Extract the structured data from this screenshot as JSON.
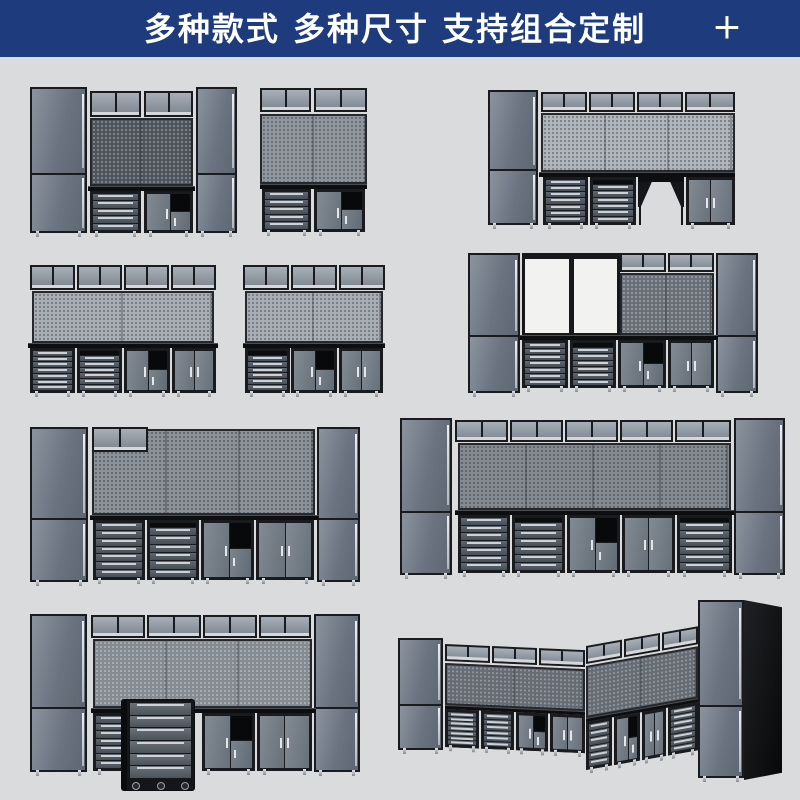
{
  "banner": {
    "title": "多种款式 多种尺寸 支持组合定制",
    "plus_icon": "+",
    "bg_color": "#1e3c7d",
    "text_color": "#ffffff"
  },
  "page": {
    "bg_color": "#dadbdc",
    "width": 800,
    "height": 800
  },
  "palette": {
    "frame": "#1a1b1e",
    "door_gray": "#6b7380",
    "silver": "#cdd1d5",
    "bench_black": "#0d0e10",
    "open_bay_white": "#f2f2f1"
  },
  "scene": {
    "units": [
      {
        "id": "combo-1",
        "x": 30,
        "y": 87,
        "w": 207,
        "h": 153,
        "parts": [
          {
            "t": "tall",
            "x": 0,
            "y": 0,
            "w": 57,
            "h": 146,
            "feet": 1
          },
          {
            "t": "wall",
            "x": 60,
            "y": 4,
            "w": 51,
            "h": 26
          },
          {
            "t": "wall",
            "x": 114,
            "y": 4,
            "w": 49,
            "h": 26
          },
          {
            "t": "peg",
            "x": 60,
            "y": 31,
            "w": 103,
            "h": 68,
            "c": "#4e545c",
            "d": "light"
          },
          {
            "t": "bench",
            "x": 58,
            "y": 99,
            "w": 107,
            "h": 5
          },
          {
            "t": "drawers",
            "x": 60,
            "y": 104,
            "w": 51,
            "h": 42,
            "n": 5,
            "feet": 1
          },
          {
            "t": "cubby",
            "x": 114,
            "y": 104,
            "w": 49,
            "h": 42,
            "feet": 1
          },
          {
            "t": "tall",
            "x": 166,
            "y": 0,
            "w": 41,
            "h": 146,
            "feet": 1
          }
        ]
      },
      {
        "id": "combo-2",
        "x": 260,
        "y": 88,
        "w": 107,
        "h": 152,
        "parts": [
          {
            "t": "wall",
            "x": 0,
            "y": 0,
            "w": 51,
            "h": 24
          },
          {
            "t": "wall",
            "x": 54,
            "y": 0,
            "w": 53,
            "h": 24
          },
          {
            "t": "peg",
            "x": 0,
            "y": 26,
            "w": 107,
            "h": 70,
            "c": "#90969e",
            "d": "dark"
          },
          {
            "t": "bench",
            "x": 0,
            "y": 96,
            "w": 107,
            "h": 5
          },
          {
            "t": "drawers",
            "x": 2,
            "y": 101,
            "w": 49,
            "h": 43,
            "n": 5,
            "feet": 1
          },
          {
            "t": "cubby",
            "x": 54,
            "y": 101,
            "w": 51,
            "h": 43,
            "feet": 1
          }
        ]
      },
      {
        "id": "combo-3",
        "x": 488,
        "y": 90,
        "w": 247,
        "h": 143,
        "parts": [
          {
            "t": "tall",
            "x": 0,
            "y": 0,
            "w": 50,
            "h": 135,
            "feet": 1
          },
          {
            "t": "wall",
            "x": 53,
            "y": 2,
            "w": 46,
            "h": 20
          },
          {
            "t": "wall",
            "x": 101,
            "y": 2,
            "w": 46,
            "h": 20
          },
          {
            "t": "wall",
            "x": 149,
            "y": 2,
            "w": 46,
            "h": 20
          },
          {
            "t": "wall",
            "x": 197,
            "y": 2,
            "w": 50,
            "h": 20
          },
          {
            "t": "peg",
            "x": 53,
            "y": 23,
            "w": 194,
            "h": 59,
            "c": "#b0b5bb",
            "d": "dark"
          },
          {
            "t": "bench",
            "x": 51,
            "y": 82,
            "w": 196,
            "h": 5
          },
          {
            "t": "drawers",
            "x": 55,
            "y": 87,
            "w": 45,
            "h": 48,
            "n": 7,
            "feet": 1
          },
          {
            "t": "drawers",
            "x": 102,
            "y": 87,
            "w": 46,
            "h": 48,
            "n": 6,
            "rail": 1,
            "feet": 1
          },
          {
            "t": "gap",
            "x": 150,
            "y": 87,
            "w": 46,
            "h": 48
          },
          {
            "t": "doors2",
            "x": 198,
            "y": 87,
            "w": 49,
            "h": 48,
            "feet": 1
          }
        ]
      },
      {
        "id": "combo-4",
        "x": 28,
        "y": 265,
        "w": 190,
        "h": 134,
        "parts": [
          {
            "t": "wall",
            "x": 2,
            "y": 0,
            "w": 45,
            "h": 25
          },
          {
            "t": "wall",
            "x": 49,
            "y": 0,
            "w": 45,
            "h": 25
          },
          {
            "t": "wall",
            "x": 96,
            "y": 0,
            "w": 45,
            "h": 25
          },
          {
            "t": "wall",
            "x": 143,
            "y": 0,
            "w": 45,
            "h": 25
          },
          {
            "t": "peg",
            "x": 4,
            "y": 26,
            "w": 182,
            "h": 52,
            "c": "#a9aeb5",
            "d": "dark"
          },
          {
            "t": "bench",
            "x": 0,
            "y": 78,
            "w": 190,
            "h": 5
          },
          {
            "t": "drawers",
            "x": 2,
            "y": 83,
            "w": 45,
            "h": 45,
            "n": 7,
            "feet": 1
          },
          {
            "t": "drawers",
            "x": 49,
            "y": 83,
            "w": 45,
            "h": 45,
            "n": 6,
            "rail": 1,
            "feet": 1
          },
          {
            "t": "cubby",
            "x": 96,
            "y": 83,
            "w": 46,
            "h": 45,
            "feet": 1
          },
          {
            "t": "doors2",
            "x": 144,
            "y": 83,
            "w": 44,
            "h": 45,
            "feet": 1
          }
        ]
      },
      {
        "id": "combo-5",
        "x": 243,
        "y": 265,
        "w": 142,
        "h": 134,
        "parts": [
          {
            "t": "wall",
            "x": 0,
            "y": 0,
            "w": 46,
            "h": 25
          },
          {
            "t": "wall",
            "x": 48,
            "y": 0,
            "w": 46,
            "h": 25
          },
          {
            "t": "wall",
            "x": 96,
            "y": 0,
            "w": 46,
            "h": 25
          },
          {
            "t": "peg",
            "x": 2,
            "y": 26,
            "w": 138,
            "h": 52,
            "c": "#a9aeb5",
            "d": "dark"
          },
          {
            "t": "bench",
            "x": 0,
            "y": 78,
            "w": 142,
            "h": 5
          },
          {
            "t": "drawers",
            "x": 2,
            "y": 83,
            "w": 45,
            "h": 45,
            "n": 6,
            "rail": 1,
            "feet": 1
          },
          {
            "t": "cubby",
            "x": 48,
            "y": 83,
            "w": 46,
            "h": 45,
            "feet": 1
          },
          {
            "t": "doors2",
            "x": 96,
            "y": 83,
            "w": 44,
            "h": 45,
            "feet": 1
          }
        ]
      },
      {
        "id": "combo-6",
        "x": 468,
        "y": 250,
        "w": 290,
        "h": 150,
        "parts": [
          {
            "t": "tall",
            "x": 0,
            "y": 3,
            "w": 52,
            "h": 140,
            "feet": 1
          },
          {
            "t": "open",
            "x": 54,
            "y": 3,
            "w": 98,
            "h": 83
          },
          {
            "t": "wall",
            "x": 152,
            "y": 3,
            "w": 46,
            "h": 19
          },
          {
            "t": "wall",
            "x": 200,
            "y": 3,
            "w": 46,
            "h": 19
          },
          {
            "t": "peg",
            "x": 152,
            "y": 23,
            "w": 94,
            "h": 62,
            "c": "#6a7078",
            "d": "light"
          },
          {
            "t": "tall",
            "x": 248,
            "y": 3,
            "w": 42,
            "h": 140,
            "feet": 1
          },
          {
            "t": "bench",
            "x": 52,
            "y": 85,
            "w": 198,
            "h": 5
          },
          {
            "t": "drawers",
            "x": 54,
            "y": 90,
            "w": 46,
            "h": 48,
            "n": 7,
            "feet": 1
          },
          {
            "t": "drawers",
            "x": 102,
            "y": 90,
            "w": 46,
            "h": 48,
            "n": 6,
            "rail": 1,
            "feet": 1
          },
          {
            "t": "cubby",
            "x": 150,
            "y": 90,
            "w": 48,
            "h": 48,
            "feet": 1
          },
          {
            "t": "doors2",
            "x": 200,
            "y": 90,
            "w": 46,
            "h": 48,
            "feet": 1
          }
        ]
      },
      {
        "id": "combo-7",
        "x": 30,
        "y": 425,
        "w": 330,
        "h": 163,
        "parts": [
          {
            "t": "tall",
            "x": 0,
            "y": 2,
            "w": 58,
            "h": 155,
            "feet": 1
          },
          {
            "t": "peg",
            "x": 62,
            "y": 4,
            "w": 223,
            "h": 86,
            "c": "#8b9199",
            "d": "dark"
          },
          {
            "t": "wall",
            "x": 62,
            "y": 2,
            "w": 56,
            "h": 25
          },
          {
            "t": "tall",
            "x": 287,
            "y": 2,
            "w": 43,
            "h": 155,
            "feet": 1
          },
          {
            "t": "bench",
            "x": 60,
            "y": 90,
            "w": 229,
            "h": 5
          },
          {
            "t": "drawers",
            "x": 63,
            "y": 95,
            "w": 52,
            "h": 60,
            "n": 7,
            "feet": 1
          },
          {
            "t": "drawers",
            "x": 117,
            "y": 95,
            "w": 52,
            "h": 60,
            "n": 6,
            "rail": 1,
            "feet": 1
          },
          {
            "t": "cubby",
            "x": 171,
            "y": 95,
            "w": 53,
            "h": 60,
            "feet": 1
          },
          {
            "t": "doors2",
            "x": 226,
            "y": 95,
            "w": 58,
            "h": 60,
            "feet": 1
          }
        ]
      },
      {
        "id": "combo-8",
        "x": 400,
        "y": 418,
        "w": 385,
        "h": 164,
        "parts": [
          {
            "t": "tall",
            "x": 0,
            "y": 0,
            "w": 52,
            "h": 157,
            "feet": 1
          },
          {
            "t": "wall",
            "x": 55,
            "y": 2,
            "w": 53,
            "h": 22
          },
          {
            "t": "wall",
            "x": 110,
            "y": 2,
            "w": 53,
            "h": 22
          },
          {
            "t": "wall",
            "x": 165,
            "y": 2,
            "w": 53,
            "h": 22
          },
          {
            "t": "wall",
            "x": 220,
            "y": 2,
            "w": 53,
            "h": 22
          },
          {
            "t": "wall",
            "x": 275,
            "y": 2,
            "w": 56,
            "h": 22
          },
          {
            "t": "peg",
            "x": 58,
            "y": 25,
            "w": 273,
            "h": 67,
            "c": "#848a92",
            "d": "dark"
          },
          {
            "t": "tall",
            "x": 334,
            "y": 0,
            "w": 51,
            "h": 157,
            "feet": 1
          },
          {
            "t": "bench",
            "x": 55,
            "y": 92,
            "w": 279,
            "h": 5
          },
          {
            "t": "drawers",
            "x": 58,
            "y": 97,
            "w": 52,
            "h": 58,
            "n": 7,
            "feet": 1
          },
          {
            "t": "drawers",
            "x": 112,
            "y": 97,
            "w": 53,
            "h": 58,
            "n": 6,
            "rail": 1,
            "feet": 1
          },
          {
            "t": "cubby",
            "x": 167,
            "y": 97,
            "w": 53,
            "h": 58,
            "feet": 1
          },
          {
            "t": "doors2",
            "x": 222,
            "y": 97,
            "w": 53,
            "h": 58,
            "feet": 1
          },
          {
            "t": "drawers",
            "x": 277,
            "y": 97,
            "w": 55,
            "h": 58,
            "n": 6,
            "rail": 1,
            "feet": 1
          }
        ]
      },
      {
        "id": "combo-9",
        "x": 30,
        "y": 612,
        "w": 330,
        "h": 178,
        "parts": [
          {
            "t": "tall",
            "x": 0,
            "y": 2,
            "w": 57,
            "h": 158,
            "feet": 1
          },
          {
            "t": "wall",
            "x": 61,
            "y": 3,
            "w": 54,
            "h": 23
          },
          {
            "t": "wall",
            "x": 117,
            "y": 3,
            "w": 54,
            "h": 23
          },
          {
            "t": "wall",
            "x": 173,
            "y": 3,
            "w": 54,
            "h": 23
          },
          {
            "t": "wall",
            "x": 229,
            "y": 3,
            "w": 52,
            "h": 23
          },
          {
            "t": "peg",
            "x": 63,
            "y": 27,
            "w": 219,
            "h": 69,
            "c": "#858b93",
            "d": "light"
          },
          {
            "t": "tall",
            "x": 284,
            "y": 2,
            "w": 46,
            "h": 158,
            "feet": 1
          },
          {
            "t": "bench",
            "x": 61,
            "y": 96,
            "w": 225,
            "h": 5
          },
          {
            "t": "drawers",
            "x": 63,
            "y": 101,
            "w": 50,
            "h": 58,
            "n": 7,
            "feet": 1
          },
          {
            "t": "cubby",
            "x": 172,
            "y": 101,
            "w": 53,
            "h": 58,
            "feet": 1
          },
          {
            "t": "doors2",
            "x": 227,
            "y": 101,
            "w": 55,
            "h": 58,
            "feet": 1
          },
          {
            "t": "cart",
            "x": 92,
            "y": 88,
            "w": 72,
            "h": 90
          }
        ]
      },
      {
        "id": "combo-10-corner",
        "x": 395,
        "y": 598,
        "w": 395,
        "h": 196,
        "parts": [
          {
            "t": "tall",
            "x": 3,
            "y": 40,
            "w": 45,
            "h": 112,
            "feet": 1
          },
          {
            "t": "wing",
            "x": 50,
            "y": 46,
            "w": 140,
            "h": 104,
            "skew": 2.5,
            "parts": [
              {
                "t": "wall",
                "x": 0,
                "y": 0,
                "w": 45,
                "h": 17
              },
              {
                "t": "wall",
                "x": 47,
                "y": 0,
                "w": 45,
                "h": 17
              },
              {
                "t": "wall",
                "x": 94,
                "y": 0,
                "w": 46,
                "h": 17
              },
              {
                "t": "peg",
                "x": 0,
                "y": 19,
                "w": 140,
                "h": 42,
                "c": "#666c74",
                "d": "light"
              },
              {
                "t": "bench",
                "x": 0,
                "y": 61,
                "w": 140,
                "h": 4
              },
              {
                "t": "drawers",
                "x": 0,
                "y": 65,
                "w": 34,
                "h": 38,
                "n": 7,
                "feet": 1
              },
              {
                "t": "drawers",
                "x": 36,
                "y": 65,
                "w": 33,
                "h": 38,
                "n": 6,
                "feet": 1
              },
              {
                "t": "cubby",
                "x": 71,
                "y": 65,
                "w": 32,
                "h": 38,
                "feet": 1
              },
              {
                "t": "doors2",
                "x": 105,
                "y": 65,
                "w": 35,
                "h": 38,
                "feet": 1
              }
            ]
          },
          {
            "t": "wing",
            "x": 191,
            "y": 48,
            "w": 112,
            "h": 124,
            "skew": -10,
            "parts": [
              {
                "t": "wall",
                "x": 0,
                "y": 0,
                "w": 36,
                "h": 18
              },
              {
                "t": "wall",
                "x": 38,
                "y": 0,
                "w": 36,
                "h": 18
              },
              {
                "t": "wall",
                "x": 76,
                "y": 0,
                "w": 36,
                "h": 18
              },
              {
                "t": "peg",
                "x": 0,
                "y": 20,
                "w": 112,
                "h": 52,
                "c": "#666c74",
                "d": "light"
              },
              {
                "t": "bench",
                "x": 0,
                "y": 72,
                "w": 112,
                "h": 4
              },
              {
                "t": "drawers",
                "x": 0,
                "y": 76,
                "w": 26,
                "h": 48,
                "n": 6,
                "feet": 1
              },
              {
                "t": "cubby",
                "x": 28,
                "y": 76,
                "w": 26,
                "h": 48,
                "feet": 1
              },
              {
                "t": "doors2",
                "x": 56,
                "y": 76,
                "w": 24,
                "h": 48,
                "feet": 1
              },
              {
                "t": "drawers",
                "x": 82,
                "y": 76,
                "w": 30,
                "h": 48,
                "n": 7,
                "feet": 1
              }
            ]
          },
          {
            "t": "side",
            "x": 349,
            "y": 2,
            "w": 38,
            "h": 180
          },
          {
            "t": "tall",
            "x": 303,
            "y": 2,
            "w": 46,
            "h": 178,
            "feet": 1
          }
        ]
      }
    ]
  }
}
